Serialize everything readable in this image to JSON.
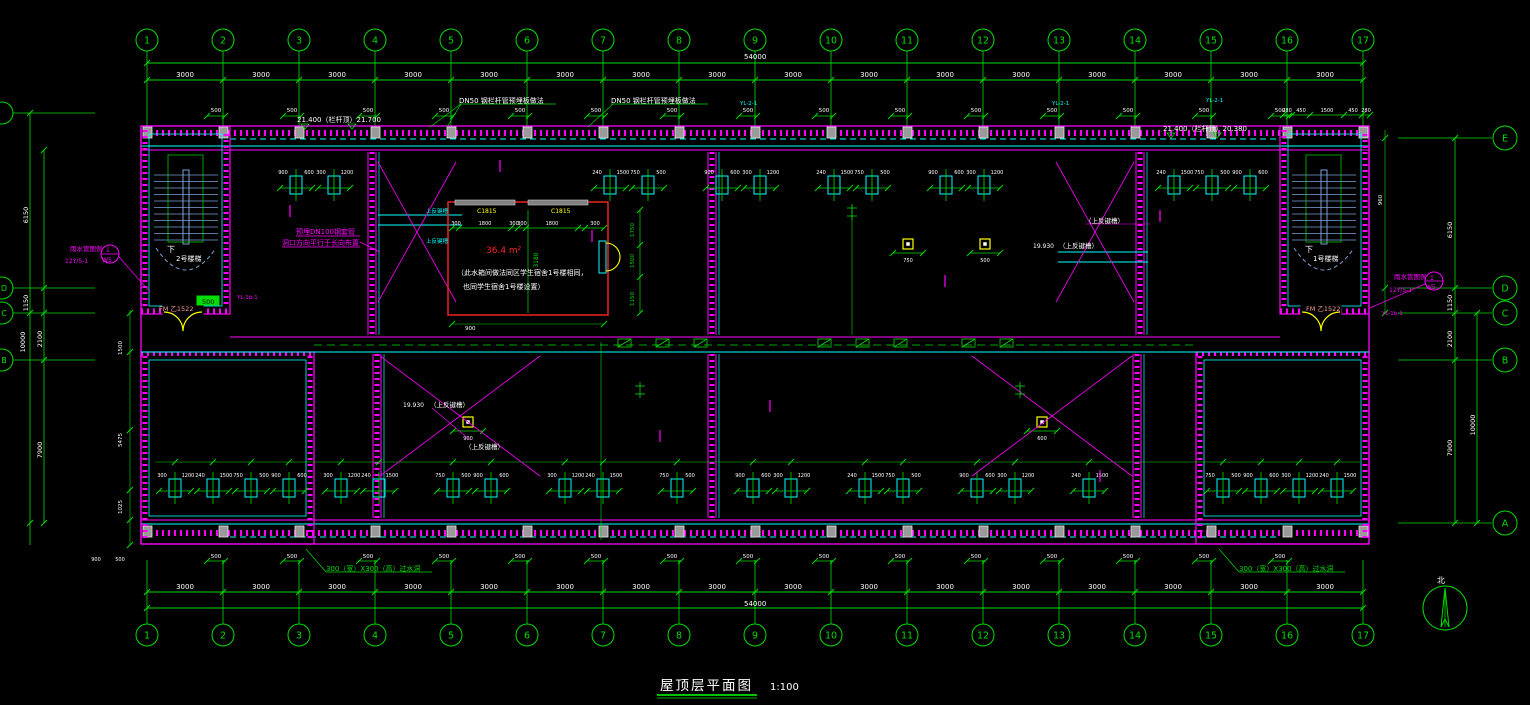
{
  "drawing": {
    "title": "屋顶层平面图",
    "scale": "1:100",
    "north": "北"
  },
  "axes": {
    "numbers": [
      "1",
      "2",
      "3",
      "4",
      "5",
      "6",
      "7",
      "8",
      "9",
      "10",
      "11",
      "12",
      "13",
      "14",
      "15",
      "16",
      "17"
    ],
    "letters": [
      "E",
      "D",
      "C",
      "B",
      "A"
    ],
    "left_letters": [
      "D",
      "C",
      "B"
    ]
  },
  "dims": {
    "total": "54000",
    "bay": "3000",
    "right_chain": [
      "6150",
      "1150",
      "2100",
      "7900"
    ],
    "right_outer": "10000",
    "left_chain": [
      "6150",
      "1150",
      "2100",
      "7900"
    ],
    "left_outer": "10000",
    "tower_chain": [
      "280",
      "450",
      "1500",
      "450",
      "280"
    ],
    "axis_offset": "500",
    "tank_chain": [
      "300",
      "1800",
      "300",
      "300",
      "1800",
      "300"
    ],
    "tank_height": "3180",
    "tank_right": [
      "1750",
      "1500",
      "1150"
    ],
    "tank_bottom": "900",
    "inner_left": [
      "1500",
      "5475",
      "1025"
    ],
    "stair_width": "960",
    "micro": [
      "900",
      "600",
      "300",
      "1200",
      "240",
      "1500",
      "750",
      "500"
    ]
  },
  "labels": {
    "railing_left": "21.400（栏杆顶）21.700",
    "railing_right": "21.400（栏杆顶）20.380",
    "dn50": "DN50  钢栏杆管预埋板做法",
    "sleeve1": "预埋DN100钢套管",
    "sleeve2": "洞口方向平行于长向布置",
    "area": "36.4 m²",
    "note1": "（此水箱间做法同区学生宿舍1号楼相同，",
    "note2": "也同学生宿舍1号楼设置）",
    "down": "下",
    "stair2": "2号楼梯",
    "stair1": "1号楼梯",
    "fm": "FM 乙1522",
    "rain1": "雨水管图例",
    "rain2": "12Y/5-1",
    "rain_c1": "1",
    "rain_c2": "W5",
    "hole": "300（宽）X300（高）过水洞",
    "upturn": "（上反键槽）",
    "level": "19.930",
    "win": "C1815",
    "yl21": "YL-2-1",
    "yl1b": "YL-1b-1",
    "box500": "500",
    "beam": "上反键槽"
  },
  "colors": {
    "background": "#000000",
    "grid_green": "#00dd00",
    "wall_magenta": "#ff00ff",
    "fixture_cyan": "#00ffff",
    "stair_blue": "#7da2d8",
    "highlight_red": "#ff2424",
    "door_yellow": "#ffff00",
    "text_white": "#ffffff"
  }
}
